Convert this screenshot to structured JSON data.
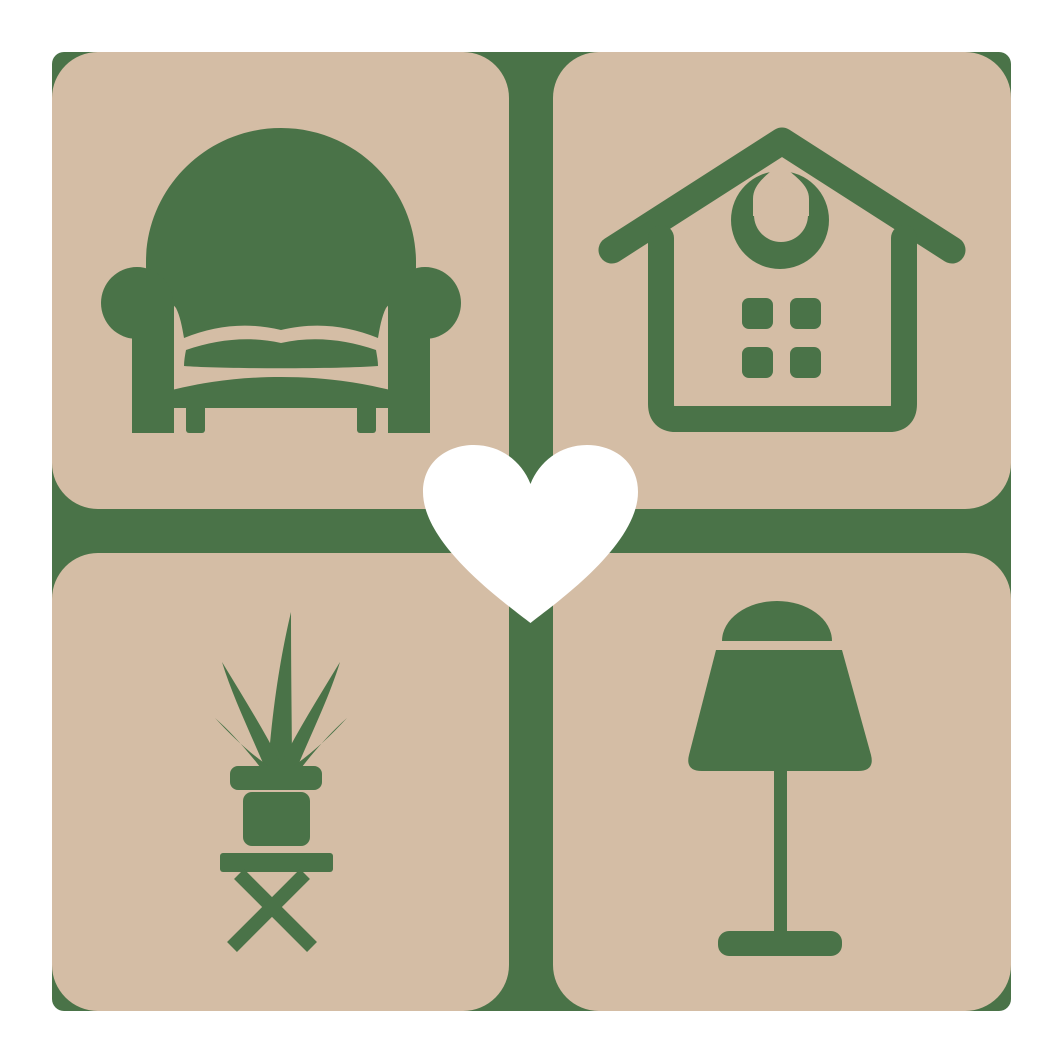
{
  "logo": {
    "grid": {
      "rows": 2,
      "cols": 2,
      "tiles": [
        {
          "position": "top-left",
          "icon": "armchair-icon"
        },
        {
          "position": "top-right",
          "icon": "house-icon"
        },
        {
          "position": "bottom-left",
          "icon": "potted-plant-icon"
        },
        {
          "position": "bottom-right",
          "icon": "table-lamp-icon"
        }
      ]
    },
    "center_icon": "heart-icon",
    "icons": {
      "top_left": "armchair-icon",
      "top_right": "house-icon",
      "bottom_left": "potted-plant-icon",
      "bottom_right": "table-lamp-icon",
      "center": "heart-icon"
    }
  },
  "colors": {
    "page_bg": "#FFFFFF",
    "tan": "#D4BDA5",
    "green": "#4A7348",
    "white": "#FFFFFF"
  }
}
